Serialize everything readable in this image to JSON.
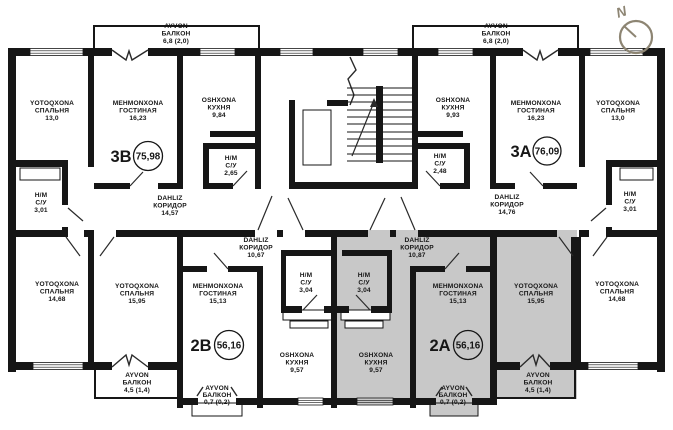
{
  "selected_apartment": "2A",
  "colors": {
    "wall": "#161616",
    "background": "#ffffff",
    "highlight": "#c8c8c8",
    "compass": "#8d8573"
  },
  "compass": {
    "label": "N"
  },
  "apartments": {
    "a3b": {
      "code": "3B",
      "area": "75,98"
    },
    "a3a": {
      "code": "3A",
      "area": "76,09"
    },
    "a2b": {
      "code": "2B",
      "area": "56,16"
    },
    "a2a": {
      "code": "2A",
      "area": "56,16"
    }
  },
  "rooms": {
    "b3_bedroom": {
      "uz": "YOTOQXONA",
      "ru": "СПАЛЬНЯ",
      "area": "13,0"
    },
    "b3_living": {
      "uz": "MEHMONXONA",
      "ru": "ГОСТИНАЯ",
      "area": "16,23"
    },
    "b3_balcony": {
      "uz": "AYVON",
      "ru": "БАЛКОН",
      "area": "6,8 (2,0)"
    },
    "b3_kitchen": {
      "uz": "OSHXONA",
      "ru": "КУХНЯ",
      "area": "9,84"
    },
    "b3_wc": {
      "uz": "H/M",
      "ru": "С/У",
      "area": "2,65"
    },
    "b3_hall": {
      "uz": "DAHLIZ",
      "ru": "КОРИДОР",
      "area": "14,57"
    },
    "wc_left": {
      "uz": "H/M",
      "ru": "С/У",
      "area": "3,01"
    },
    "bedroom_bl": {
      "uz": "YOTOQXONA",
      "ru": "СПАЛЬНЯ",
      "area": "14,68"
    },
    "a3_kitchen": {
      "uz": "OSHXONA",
      "ru": "КУХНЯ",
      "area": "9,93"
    },
    "a3_living": {
      "uz": "MEHMONXONA",
      "ru": "ГОСТИНАЯ",
      "area": "16,23"
    },
    "a3_balcony": {
      "uz": "AYVON",
      "ru": "БАЛКОН",
      "area": "6,8 (2,0)"
    },
    "a3_bedroom": {
      "uz": "YOTOQXONA",
      "ru": "СПАЛЬНЯ",
      "area": "13,0"
    },
    "a3_wc": {
      "uz": "H/M",
      "ru": "С/У",
      "area": "2,48"
    },
    "a3_hall": {
      "uz": "DAHLIZ",
      "ru": "КОРИДОР",
      "area": "14,76"
    },
    "wc_right": {
      "uz": "H/M",
      "ru": "С/У",
      "area": "3,01"
    },
    "b2_bedroom": {
      "uz": "YOTOQXONA",
      "ru": "СПАЛЬНЯ",
      "area": "15,95"
    },
    "b2_living": {
      "uz": "MEHMONXONA",
      "ru": "ГОСТИНАЯ",
      "area": "15,13"
    },
    "b2_hall": {
      "uz": "DAHLIZ",
      "ru": "КОРИДОР",
      "area": "10,67"
    },
    "b2_wc": {
      "uz": "H/M",
      "ru": "С/У",
      "area": "3,04"
    },
    "b2_kitchen": {
      "uz": "OSHXONA",
      "ru": "КУХНЯ",
      "area": "9,57"
    },
    "b2_balcony": {
      "uz": "AYVON",
      "ru": "БАЛКОН",
      "area": "4,5 (1,4)"
    },
    "b2_balcony_small": {
      "uz": "AYVON",
      "ru": "БАЛКОН",
      "area": "0,7 (0,2)"
    },
    "a2_wc": {
      "uz": "H/M",
      "ru": "С/У",
      "area": "3,04"
    },
    "a2_kitchen": {
      "uz": "OSHXONA",
      "ru": "КУХНЯ",
      "area": "9,57"
    },
    "a2_hall": {
      "uz": "DAHLIZ",
      "ru": "КОРИДОР",
      "area": "10,87"
    },
    "a2_living": {
      "uz": "MEHMONXONA",
      "ru": "ГОСТИНАЯ",
      "area": "15,13"
    },
    "a2_bedroom": {
      "uz": "YOTOQXONA",
      "ru": "СПАЛЬНЯ",
      "area": "15,95"
    },
    "a2_balcony": {
      "uz": "AYVON",
      "ru": "БАЛКОН",
      "area": "4,5 (1,4)"
    },
    "a2_balcony_small": {
      "uz": "AYVON",
      "ru": "БАЛКОН",
      "area": "0,7 (0,2)"
    },
    "bedroom_br": {
      "uz": "YOTOQXONA",
      "ru": "СПАЛЬНЯ",
      "area": "14,68"
    }
  }
}
